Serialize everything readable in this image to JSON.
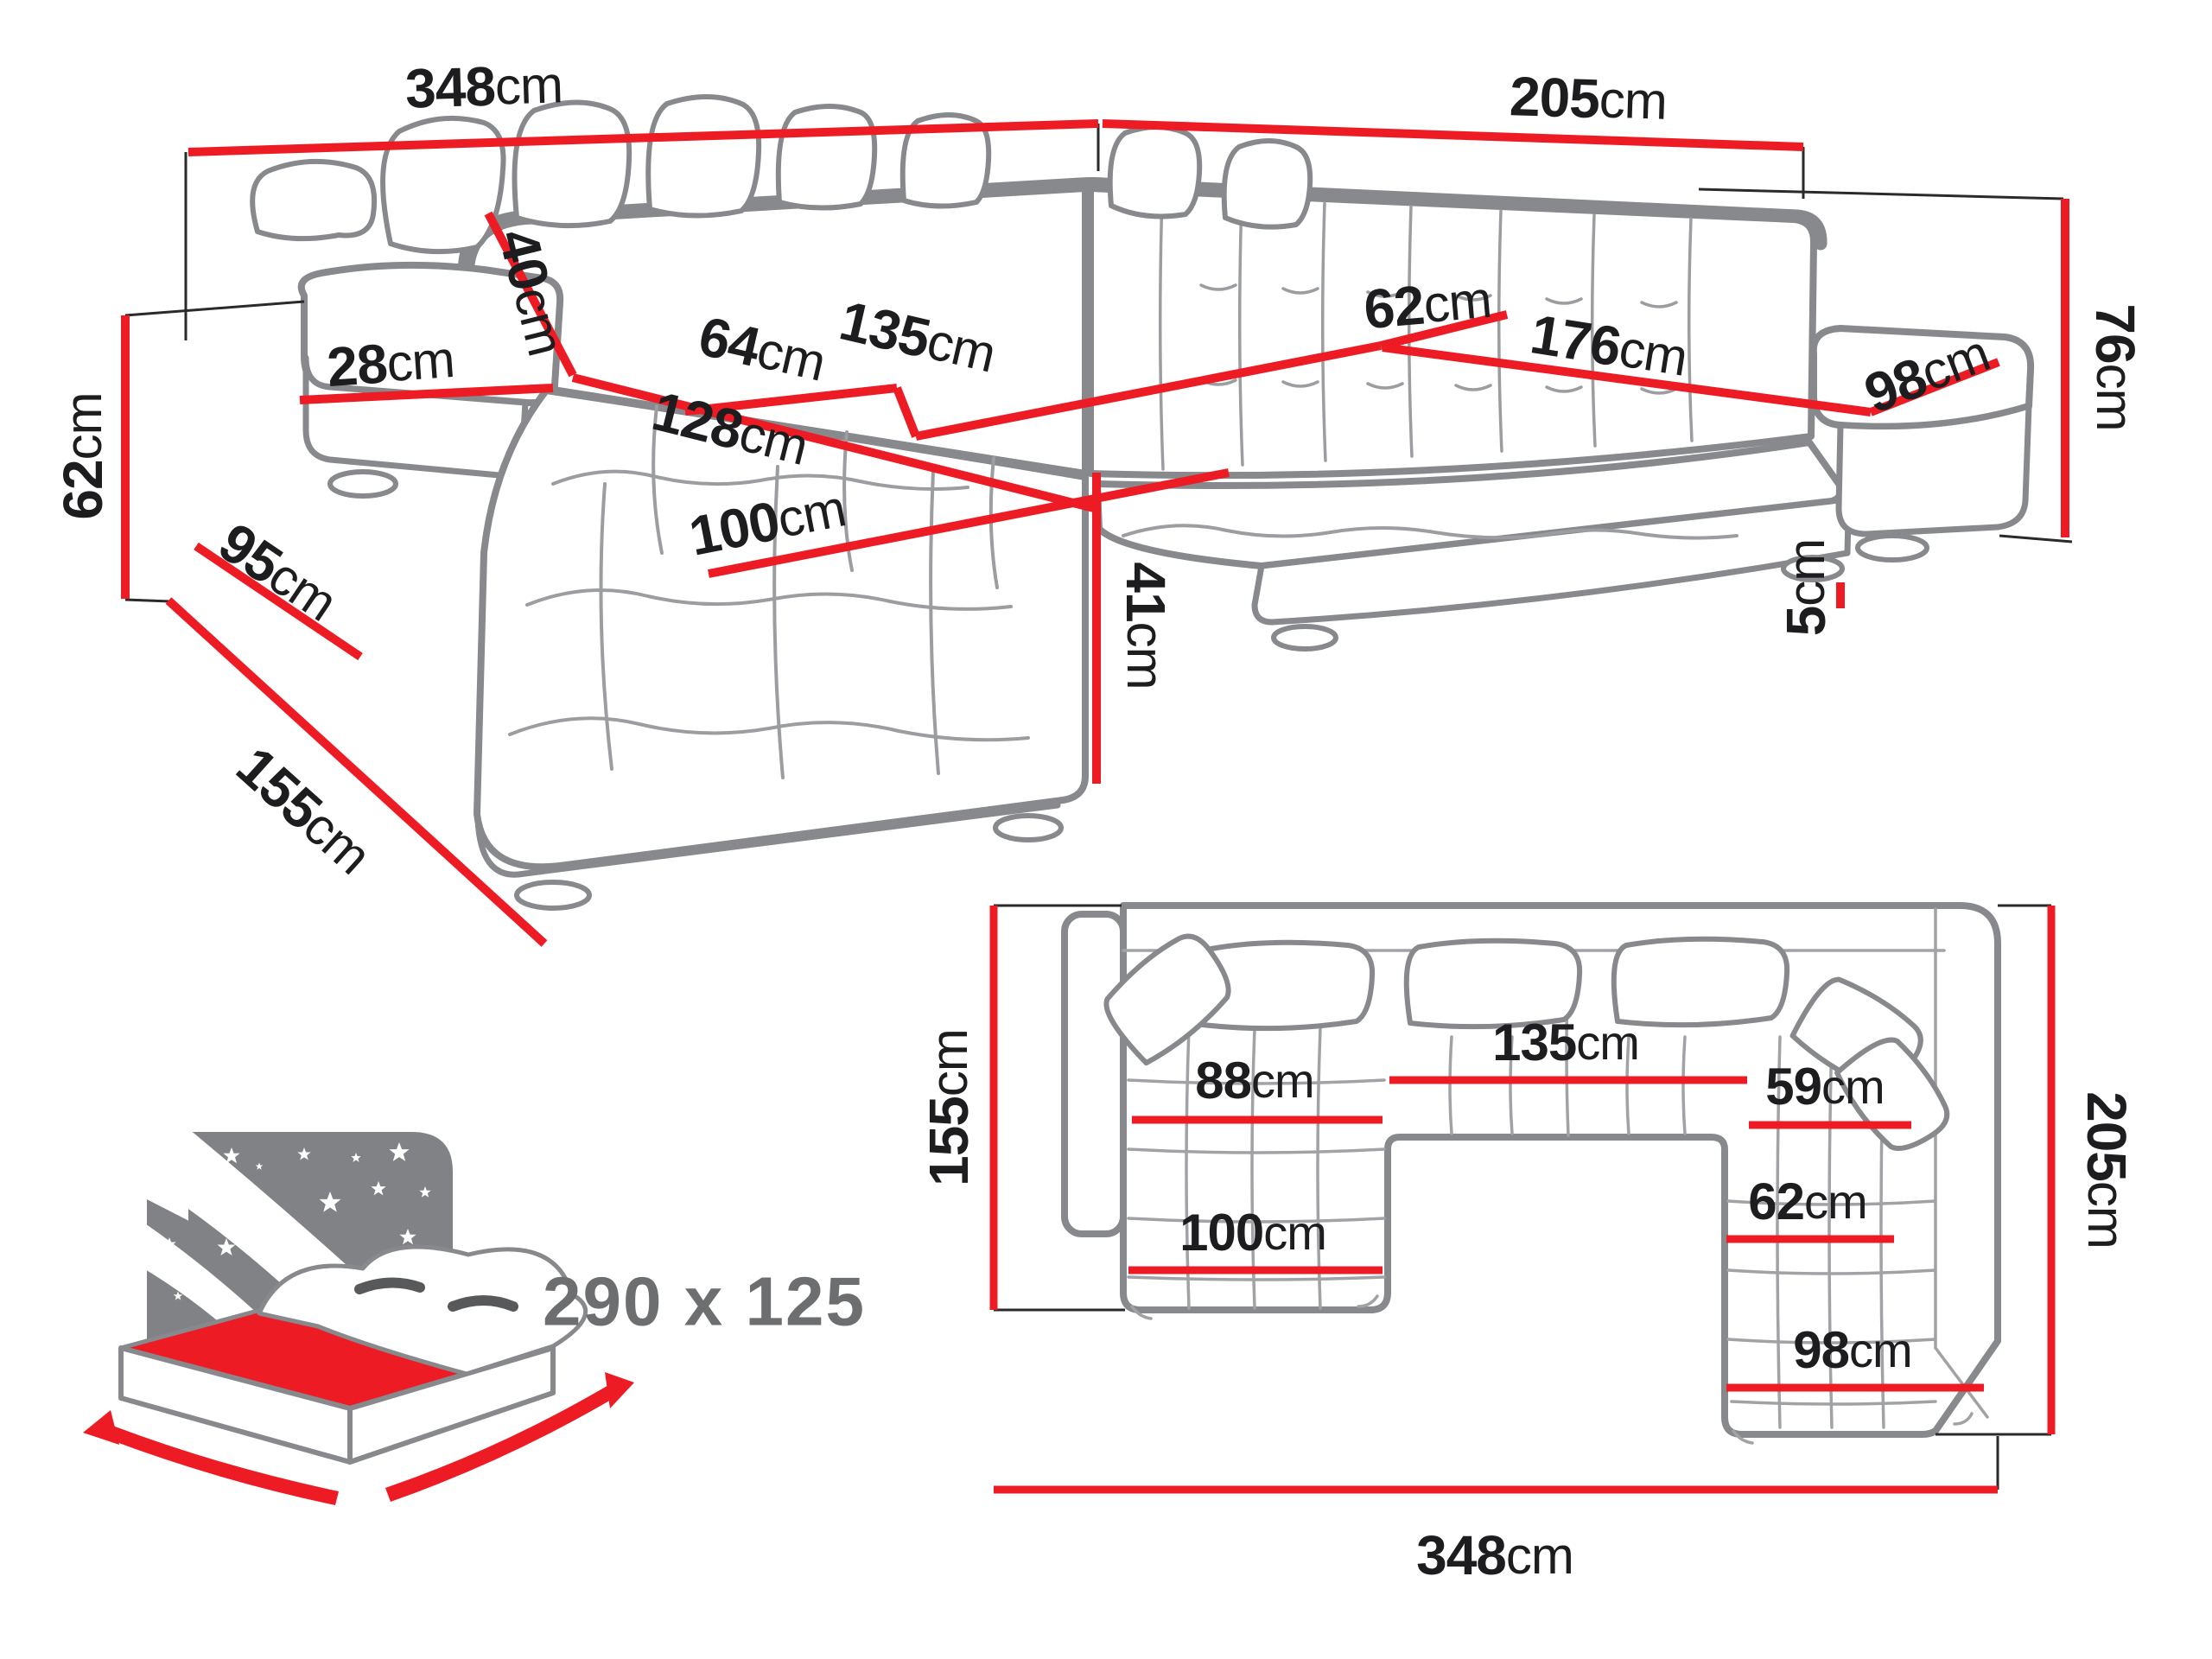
{
  "colors": {
    "dimension_red": "#ed1c24",
    "outline_gray": "#87898c",
    "tuft_gray": "#9b9da0",
    "text_black": "#1d1d1f",
    "muted_gray": "#6d6e70"
  },
  "perspective": {
    "labels": {
      "back_width_left": {
        "value": "348",
        "unit": "cm"
      },
      "back_width_right": {
        "value": "205",
        "unit": "cm"
      },
      "back_height": {
        "value": "76",
        "unit": "cm"
      },
      "arm_height": {
        "value": "62",
        "unit": "cm"
      },
      "arm_top_width": {
        "value": "28",
        "unit": "cm"
      },
      "back_pillow": {
        "value": "40",
        "unit": "cm"
      },
      "arm_length": {
        "value": "95",
        "unit": "cm"
      },
      "chaise_side": {
        "value": "155",
        "unit": "cm"
      },
      "chaise_diagonal": {
        "value": "128",
        "unit": "cm"
      },
      "seat_depth_mid": {
        "value": "64",
        "unit": "cm"
      },
      "mid_seat_width": {
        "value": "135",
        "unit": "cm"
      },
      "seat_depth_right": {
        "value": "62",
        "unit": "cm"
      },
      "right_seat_length": {
        "value": "176",
        "unit": "cm"
      },
      "right_arm_length": {
        "value": "98",
        "unit": "cm"
      },
      "seat_height": {
        "value": "41",
        "unit": "cm"
      },
      "chaise_width": {
        "value": "100",
        "unit": "cm"
      },
      "leg_height": {
        "value": "5",
        "unit": "cm"
      }
    }
  },
  "plan": {
    "labels": {
      "left_depth": {
        "value": "155",
        "unit": "cm"
      },
      "right_depth": {
        "value": "205",
        "unit": "cm"
      },
      "total_width": {
        "value": "348",
        "unit": "cm"
      },
      "left_seat": {
        "value": "88",
        "unit": "cm"
      },
      "mid_seat": {
        "value": "135",
        "unit": "cm"
      },
      "right_seat": {
        "value": "59",
        "unit": "cm"
      },
      "right_lower": {
        "value": "62",
        "unit": "cm"
      },
      "chaise_width": {
        "value": "100",
        "unit": "cm"
      },
      "right_chaise": {
        "value": "98",
        "unit": "cm"
      }
    }
  },
  "bed": {
    "sleeping_size": "290 x 125"
  }
}
